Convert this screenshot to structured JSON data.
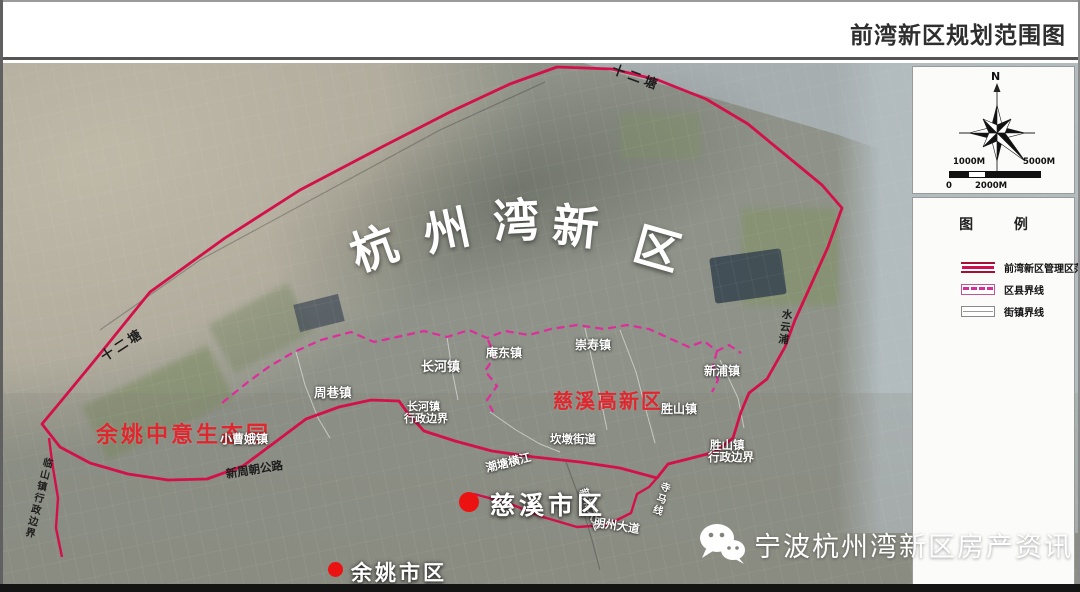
{
  "header": {
    "title": "前湾新区规划范围图"
  },
  "compass": {
    "north": "N",
    "scale_labels": {
      "upper_left": "1000M",
      "upper_right": "5000M",
      "lower_left": "0",
      "lower_mid": "2000M"
    }
  },
  "legend": {
    "title": "图 例",
    "items": [
      {
        "label": "前湾新区管理区范围",
        "swatch": "red-double-line"
      },
      {
        "label": "区县界线",
        "swatch": "magenta-dashed-line"
      },
      {
        "label": "街镇界线",
        "swatch": "gray-thin-line"
      }
    ]
  },
  "map": {
    "big_label": {
      "text": "杭州湾新区",
      "chars": [
        "杭",
        "州",
        "湾",
        "新",
        "区"
      ]
    },
    "area_labels": [
      {
        "text": "余姚中意生态园",
        "color": "#e0262e"
      },
      {
        "text": "慈溪高新区",
        "color": "#e0262e"
      }
    ],
    "city_markers": [
      {
        "text": "慈溪市区"
      },
      {
        "text": "余姚市区"
      }
    ],
    "labels": [
      {
        "text": "十二塘"
      },
      {
        "text": "十二塘"
      },
      {
        "text": "小曹娥镇"
      },
      {
        "text": "周巷镇"
      },
      {
        "text": "长河镇"
      },
      {
        "text": "庵东镇"
      },
      {
        "text": "崇寿镇"
      },
      {
        "text": "新浦镇"
      },
      {
        "text": "胜山镇"
      },
      {
        "text": "坎墩街道"
      },
      {
        "text": "长河镇"
      },
      {
        "text": "行政边界"
      },
      {
        "text": "胜山镇"
      },
      {
        "text": "行政边界"
      },
      {
        "text": "临山镇行政边界"
      },
      {
        "text": "新周朝公路"
      },
      {
        "text": "潮塘横江"
      },
      {
        "text": "新城大道"
      },
      {
        "text": "明州大道"
      },
      {
        "text": "寺马线"
      },
      {
        "text": "水云浦"
      }
    ]
  },
  "watermark": {
    "text": "宁波杭州湾新区房产资讯",
    "icon": "wechat-icon"
  },
  "colors": {
    "boundary_red": "#d31049",
    "county_line_magenta": "#df2b9b",
    "area_label_red": "#e0262e",
    "marker_red": "#ec1212",
    "big_label_white": "#ffffff"
  }
}
